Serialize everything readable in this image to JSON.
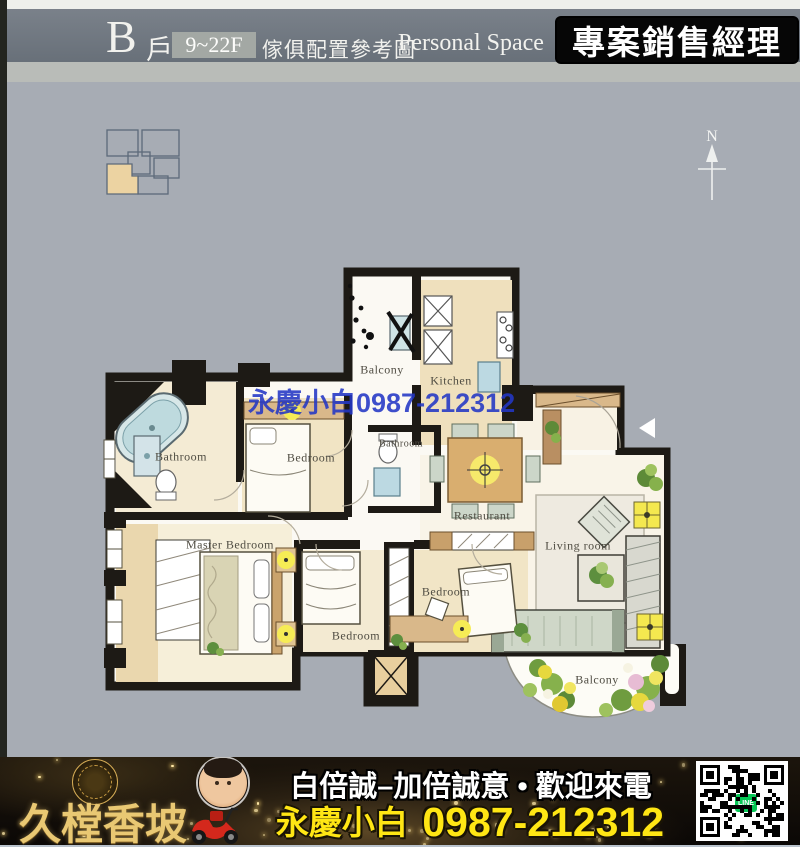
{
  "header": {
    "unit_letter": "B",
    "unit_suffix": "戶",
    "floor_range": "9~22F",
    "title_zh": "傢俱配置參考圖",
    "title_en": "Personal Space",
    "badge": "專案銷售經理"
  },
  "compass_label": "N",
  "watermark_text": "永慶小白0987-212312",
  "plan": {
    "rooms": {
      "balcony_top": "Balcony",
      "kitchen": "Kitchen",
      "bathroom_left": "Bathroom",
      "bedroom_mid": "Bedroom",
      "bathroom_mid": "Bathroom",
      "restaurant": "Restaurant",
      "master_bedroom": "Master Bedroom",
      "living_room": "Living room",
      "bedroom_bottom_left": "Bedroom",
      "bedroom_bottom_right": "Bedroom",
      "balcony_bottom": "Balcony"
    }
  },
  "banner": {
    "brand": "久樘香坡",
    "slogan": "白倍誠–加倍誠意 • 歡迎來電",
    "agent_name": "永慶小白",
    "phone": "0987-212312",
    "line_label": "LINE"
  },
  "colors": {
    "page_bg": "#a7acb4",
    "header_band": "#6f7680",
    "plan_wall": "#1d1a15",
    "room_tan": "#efe2c0",
    "unit_highlight": "#ecd3a2",
    "watermark_blue": "#2337c6",
    "banner_gold": "#e9c873",
    "banner_yellow": "#ffe614",
    "line_green": "#06c755"
  }
}
